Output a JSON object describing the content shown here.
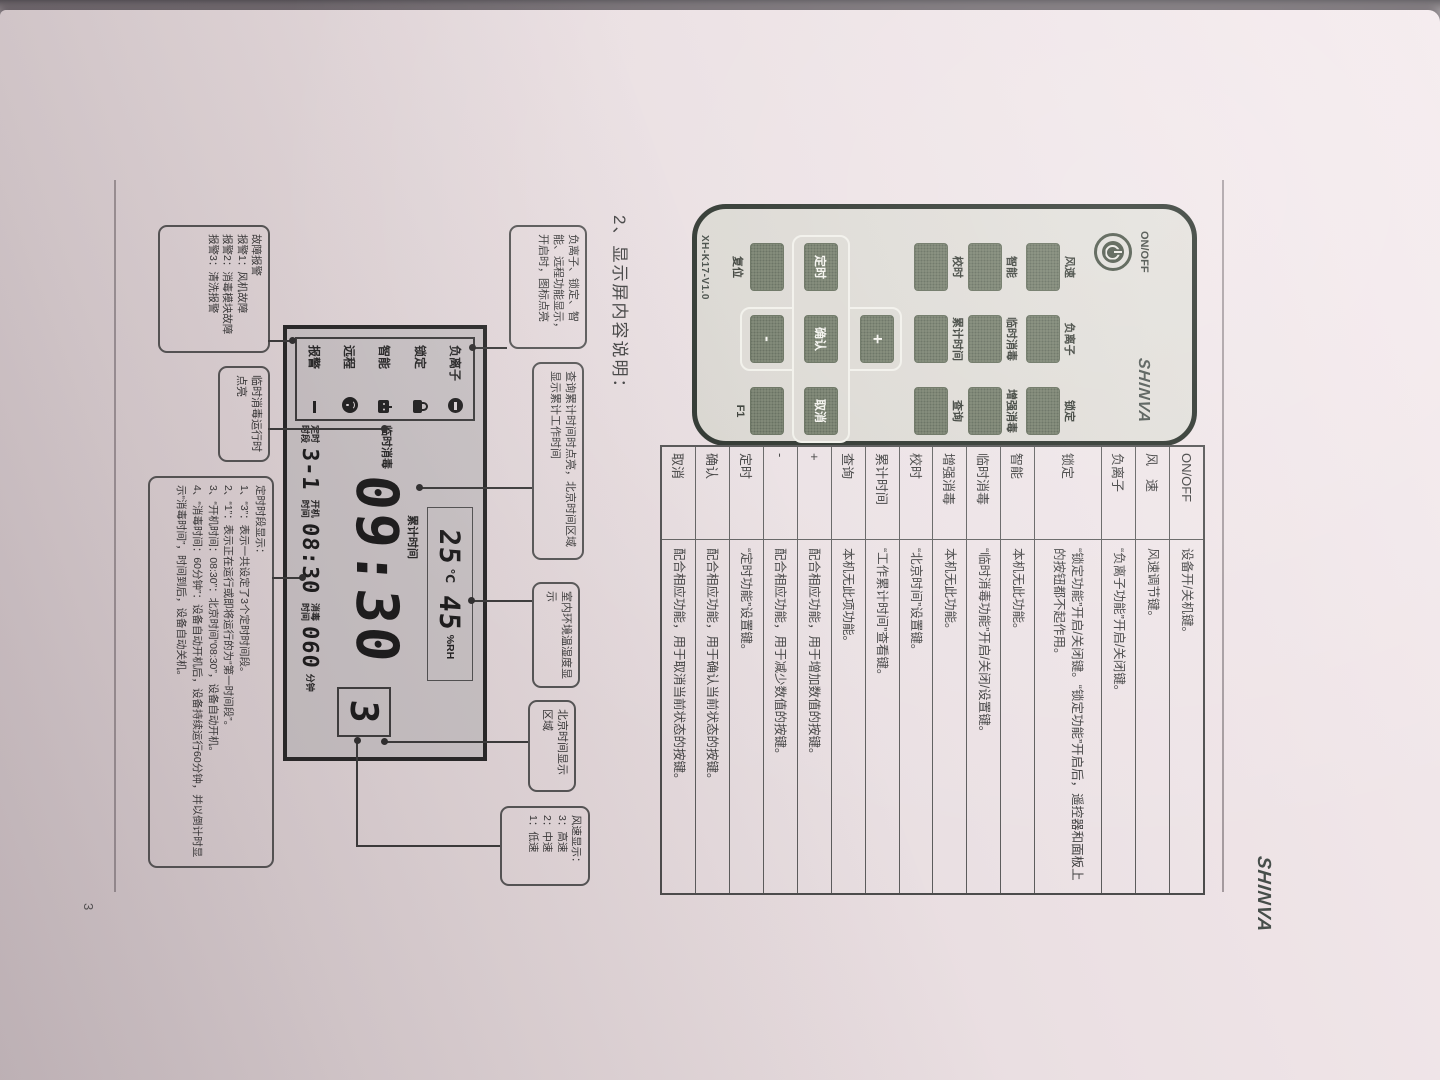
{
  "page": {
    "number": "3",
    "header_brand": "SHINVA",
    "section_title": "2、显示屏内容说明："
  },
  "remote": {
    "power_label": "ON/OFF",
    "brand": "SHINVA",
    "model": "XH-K17-V1.0",
    "grid_labels": [
      "风速",
      "负离子",
      "锁定",
      "智能",
      "临时消毒",
      "增强消毒",
      "校时",
      "累计时间",
      "查询"
    ],
    "dpad": {
      "up": "+",
      "down": "-",
      "left": "定时",
      "center": "确认",
      "right": "取消"
    },
    "reset_label": "复位",
    "f1_label": "F1"
  },
  "table": {
    "rows": [
      {
        "key": "ON/OFF",
        "desc": "设备开/关机键。"
      },
      {
        "key": "风　速",
        "desc": "风速调节键。"
      },
      {
        "key": "负离子",
        "desc": "“负离子功能”开启/关闭键。"
      },
      {
        "key": "锁定",
        "desc": "“锁定功能”开启/关闭键。“锁定功能”开启后，遥控器和面板上的按钮都不起作用。"
      },
      {
        "key": "智能",
        "desc": "本机无此功能。"
      },
      {
        "key": "临时消毒",
        "desc": "“临时消毒功能”开启/关闭/设置键。"
      },
      {
        "key": "增强消毒",
        "desc": "本机无此功能。"
      },
      {
        "key": "校时",
        "desc": "“北京时间”设置键。"
      },
      {
        "key": "累计时间",
        "desc": "“工作累计时间”查看键。"
      },
      {
        "key": "查询",
        "desc": "本机无此项功能。"
      },
      {
        "key": "+",
        "desc": "配合相应功能，用于增加数值的按键。"
      },
      {
        "key": "-",
        "desc": "配合相应功能，用于减少数值的按键。"
      },
      {
        "key": "定时",
        "desc": "“定时功能”设置键。"
      },
      {
        "key": "确认",
        "desc": "配合相应功能，用于确认当前状态的按键。"
      },
      {
        "key": "取消",
        "desc": "配合相应功能，用于取消当前状态的按键。"
      }
    ]
  },
  "lcd": {
    "status": [
      {
        "label": "负离子",
        "icon": "ion-icon"
      },
      {
        "label": "锁定",
        "icon": "lock-icon"
      },
      {
        "label": "智能",
        "icon": "smart-icon"
      },
      {
        "label": "远程",
        "icon": "wifi-icon"
      },
      {
        "label": "报警",
        "icon": "alarm-dash-icon"
      }
    ],
    "temp_value": "25",
    "temp_unit": "℃",
    "humidity_value": "45",
    "humidity_unit": "%RH",
    "time": "09:30",
    "fan_speed": "3",
    "temporary_label": "临时消毒",
    "cumulative_label": "累计时间",
    "timer_label_1": "定时",
    "timer_label_2": "时段",
    "timer_value": "3-1",
    "power_on_label_1": "开机",
    "power_on_label_2": "时间",
    "power_on_value": "08:30",
    "disinfect_label_1": "消毒",
    "disinfect_label_2": "时间",
    "disinfect_value": "060",
    "minutes_label": "分钟"
  },
  "callouts": {
    "ion_status": "负离子、锁定、智能、远程功能显示，开启时，图标点亮",
    "cumulative": "查询累计时间时点亮，北京时间区域显示累计工作时间",
    "temp_humidity": "室内环境温湿度显示",
    "beijing_time": "北京时间显示区域",
    "fan_display": {
      "title": "风速显示：",
      "line1": "3：高速",
      "line2": "2：中速",
      "line3": "1：低速"
    },
    "alarm": {
      "title": "故障报警",
      "line1": "报警1：风机故障",
      "line2": "报警2：消毒模块故障",
      "line3": "报警3：清洗报警"
    },
    "temporary": "临时消毒运行时点亮",
    "timer": {
      "title": "定时时段显示：",
      "line1": "1、“3”：表示一共设定了3个定时时间段。",
      "line2": "2、“1”：表示正在运行或即将运行的为“第一时间段”。",
      "line3": "3、“开机时间：08:30”：北京时间“08:30”，设备自动开机。",
      "line4": "4、“消毒时间：60分钟”：设备自动开机后，设备持续运行60分钟，并以倒计时显示“消毒时间”，时间到后，设备自动关机。"
    }
  }
}
